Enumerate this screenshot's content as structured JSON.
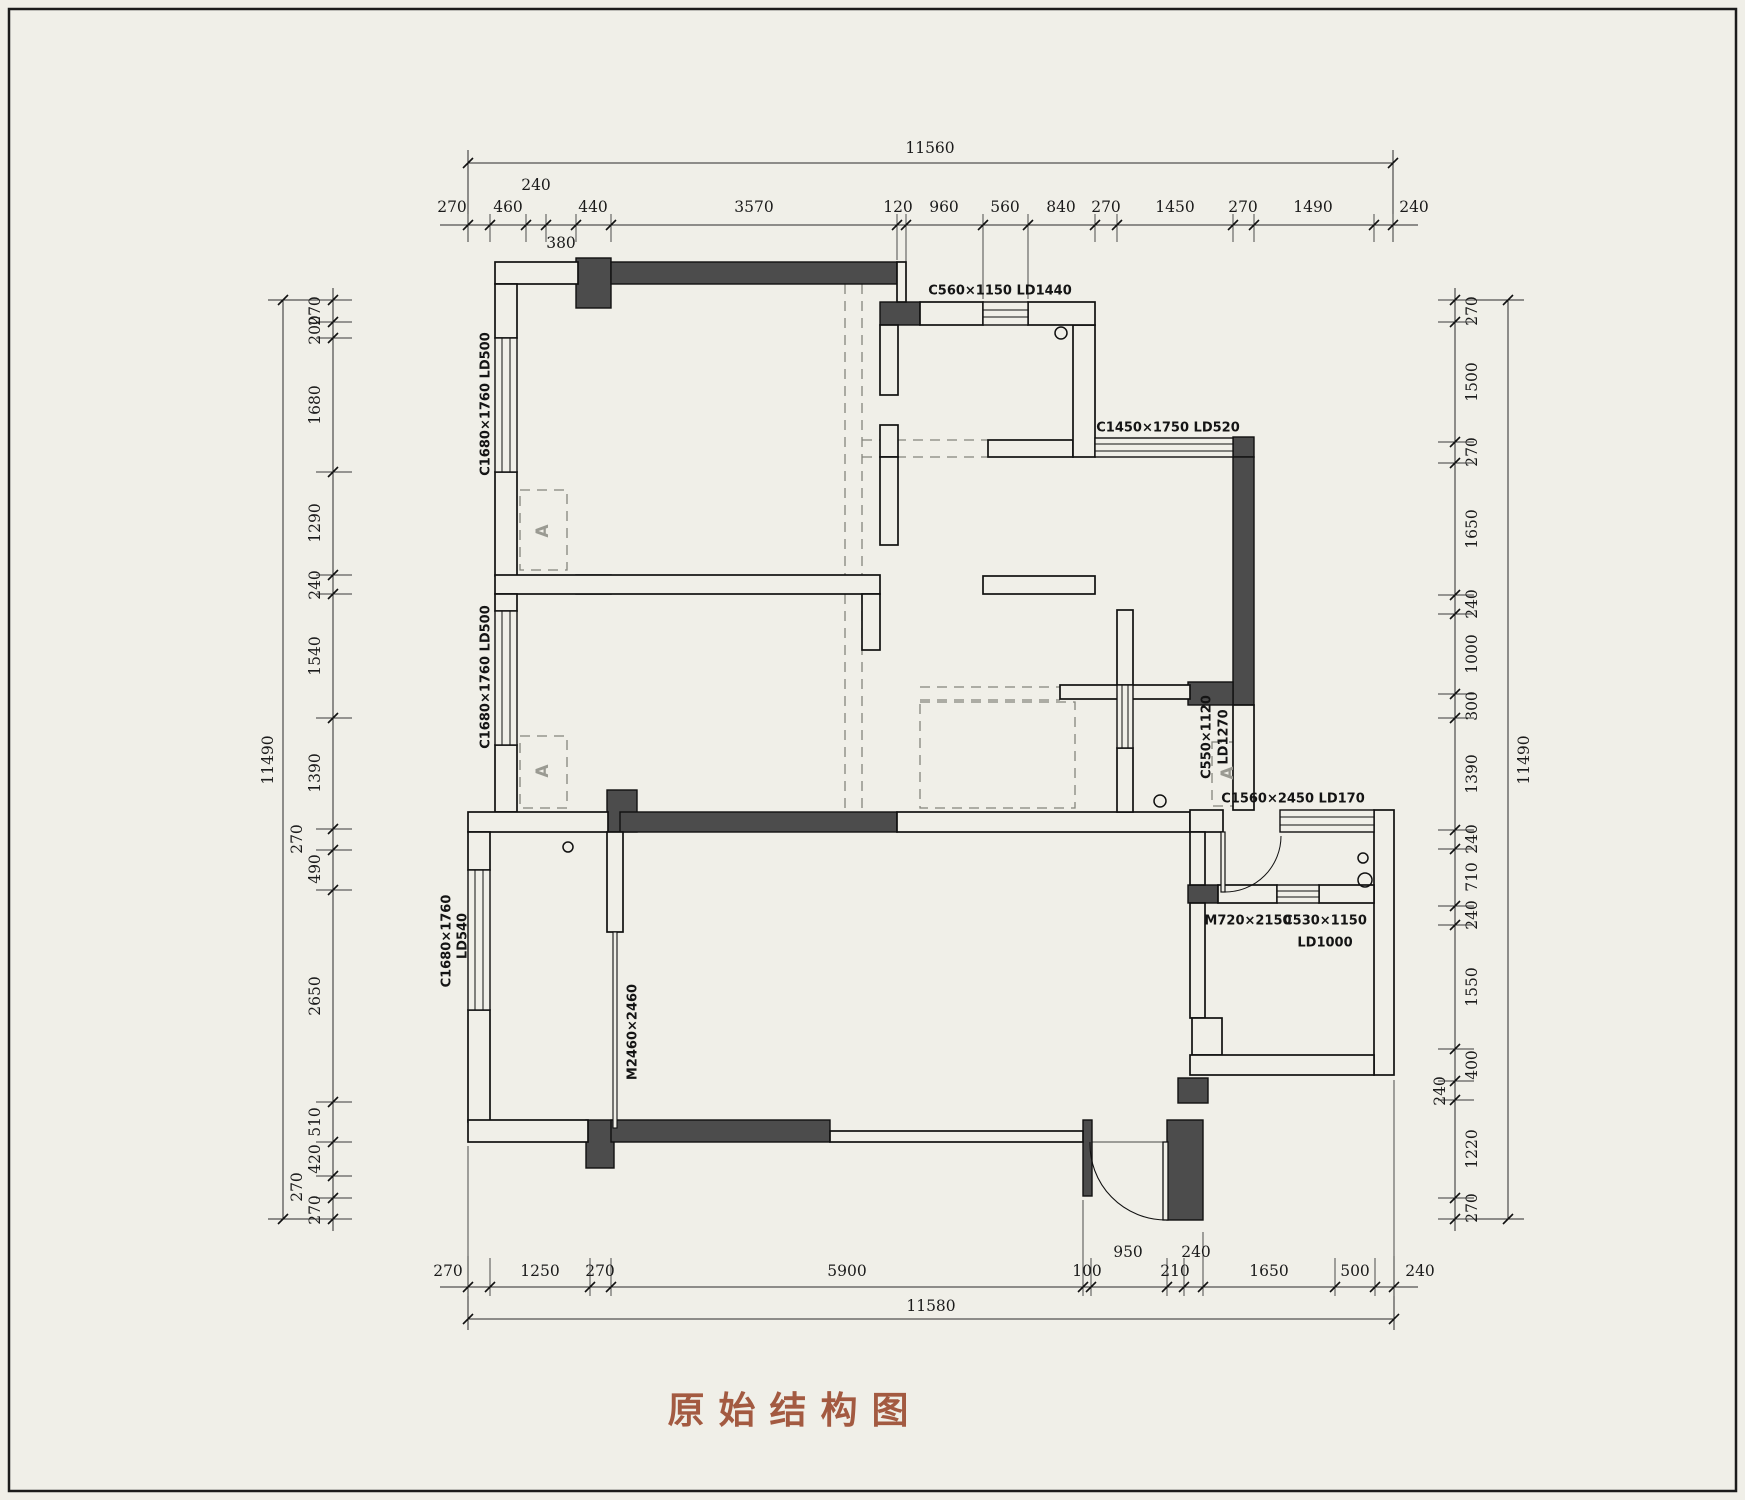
{
  "title": {
    "text": "原始结构图"
  },
  "colors": {
    "background": "#f0efe8",
    "wall_dark": "#4c4c4c",
    "line": "#1c1c1c",
    "title": "#a35a41"
  },
  "dims": {
    "top": {
      "overall": "11560",
      "segments": [
        "270",
        "460",
        "240",
        "380",
        "440",
        "3570",
        "120",
        "960",
        "560",
        "840",
        "270",
        "1450",
        "270",
        "1490",
        "240"
      ]
    },
    "bottom": {
      "overall": "11580",
      "segments": [
        "270",
        "1250",
        "270",
        "5900",
        "100",
        "950",
        "210",
        "240",
        "1650",
        "500",
        "240"
      ]
    },
    "left": {
      "overall": "11490",
      "segments": [
        "270",
        "200",
        "1680",
        "1290",
        "240",
        "1540",
        "1390",
        "270",
        "490",
        "2650",
        "510",
        "420",
        "270",
        "270"
      ]
    },
    "right": {
      "overall": "11490",
      "segments": [
        "270",
        "1500",
        "270",
        "1650",
        "240",
        "1000",
        "300",
        "1390",
        "240",
        "710",
        "240",
        "1550",
        "400",
        "240",
        "1220",
        "270"
      ]
    }
  },
  "fixtures": {
    "win_kitchen_top": "C560×1150 LD1440",
    "win_kitchen_right": "C1450×1750 LD520",
    "win_bed1": "C1680×1760 LD500",
    "win_bed2": "C1680×1760 LD500",
    "win_living_line1": "C1680×1760",
    "win_living_line2": "LD540",
    "door_balcony": "M2460×2460",
    "win_niche_line1": "C550×1120",
    "win_niche_line2": "LD1270",
    "win_bath_top": "C1560×2450 LD170",
    "door_bath": "M720×2150",
    "win_bath_bottom": "C530×1150",
    "win_bath_bottom_ld": "LD1000",
    "ac_symbol": "A"
  }
}
